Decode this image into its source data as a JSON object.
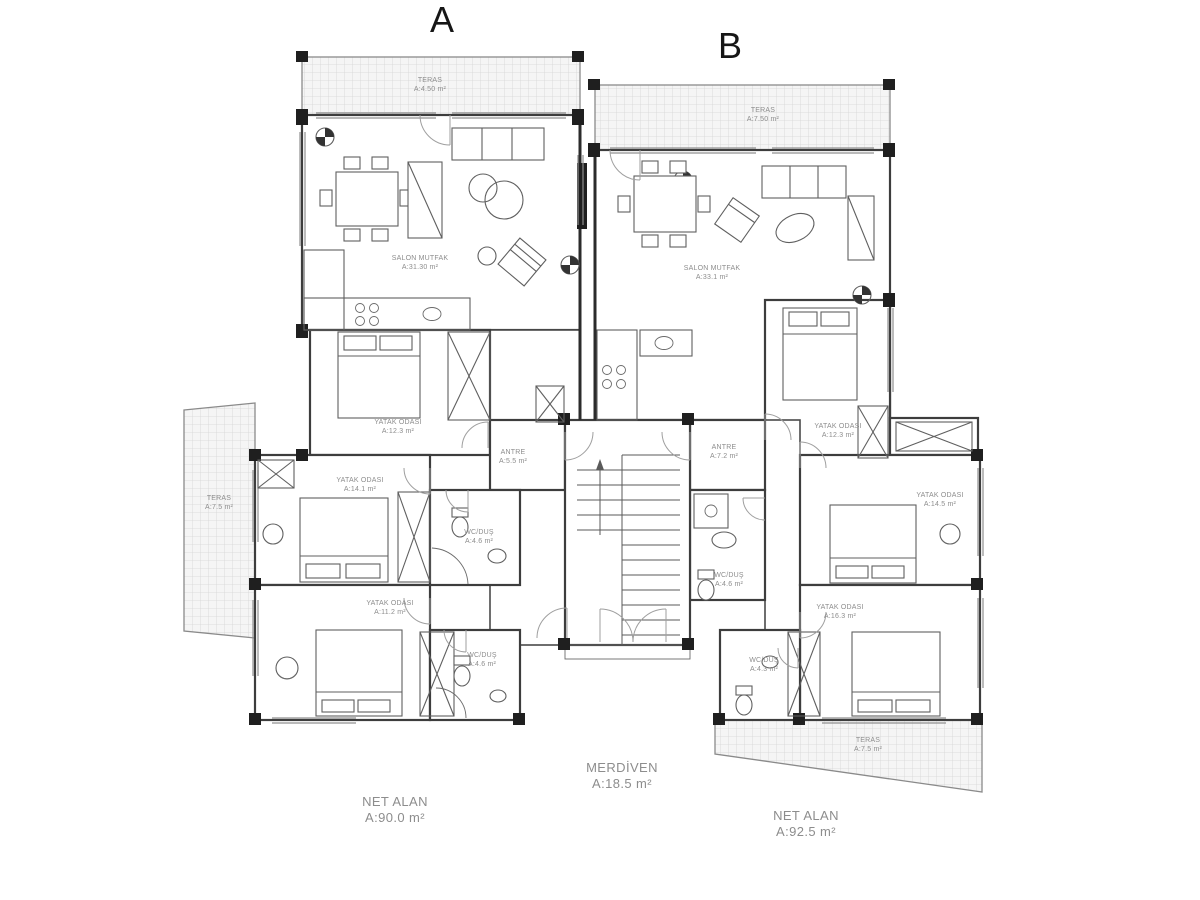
{
  "units": {
    "a_label": "A",
    "b_label": "B"
  },
  "rooms": {
    "a_teras_top": {
      "name": "TERAS",
      "area": "A:4.50 m²"
    },
    "a_teras_left": {
      "name": "TERAS",
      "area": "A:7.5 m²"
    },
    "a_salon": {
      "name": "SALON MUTFAK",
      "area": "A:31.30 m²"
    },
    "a_yatak_1": {
      "name": "YATAK ODASI",
      "area": "A:12.3 m²"
    },
    "a_yatak_2": {
      "name": "YATAK ODASI",
      "area": "A:14.1 m²"
    },
    "a_yatak_3": {
      "name": "YATAK ODASI",
      "area": "A:11.2 m²"
    },
    "a_wc_1": {
      "name": "WC/DUŞ",
      "area": "A:4.6 m²"
    },
    "a_wc_2": {
      "name": "WC/DUŞ",
      "area": "A:4.6 m²"
    },
    "a_antre": {
      "name": "ANTRE",
      "area": "A:5.5 m²"
    },
    "b_teras_top": {
      "name": "TERAS",
      "area": "A:7.50 m²"
    },
    "b_teras_bottom": {
      "name": "TERAS",
      "area": "A:7.5 m²"
    },
    "b_salon": {
      "name": "SALON MUTFAK",
      "area": "A:33.1 m²"
    },
    "b_yatak_1": {
      "name": "YATAK ODASI",
      "area": "A:12.3 m²"
    },
    "b_yatak_2": {
      "name": "YATAK ODASI",
      "area": "A:14.5 m²"
    },
    "b_yatak_3": {
      "name": "YATAK ODASI",
      "area": "A:16.3 m²"
    },
    "b_wc_1": {
      "name": "WC/DUŞ",
      "area": "A:4.6 m²"
    },
    "b_wc_2": {
      "name": "WC/DUŞ",
      "area": "A:4.3 m²"
    },
    "b_antre": {
      "name": "ANTRE",
      "area": "A:7.2 m²"
    }
  },
  "summary": {
    "merdiven": {
      "name": "MERDİVEN",
      "area": "A:18.5 m²"
    },
    "net_alan_a": {
      "name": "NET ALAN",
      "area": "A:90.0 m²"
    },
    "net_alan_b": {
      "name": "NET ALAN",
      "area": "A:92.5 m²"
    }
  },
  "colors": {
    "wall": "#2b2b2b",
    "line": "#5f5f5f",
    "muted_text": "#8d8d8d",
    "hatch": "#d6d6d6"
  }
}
